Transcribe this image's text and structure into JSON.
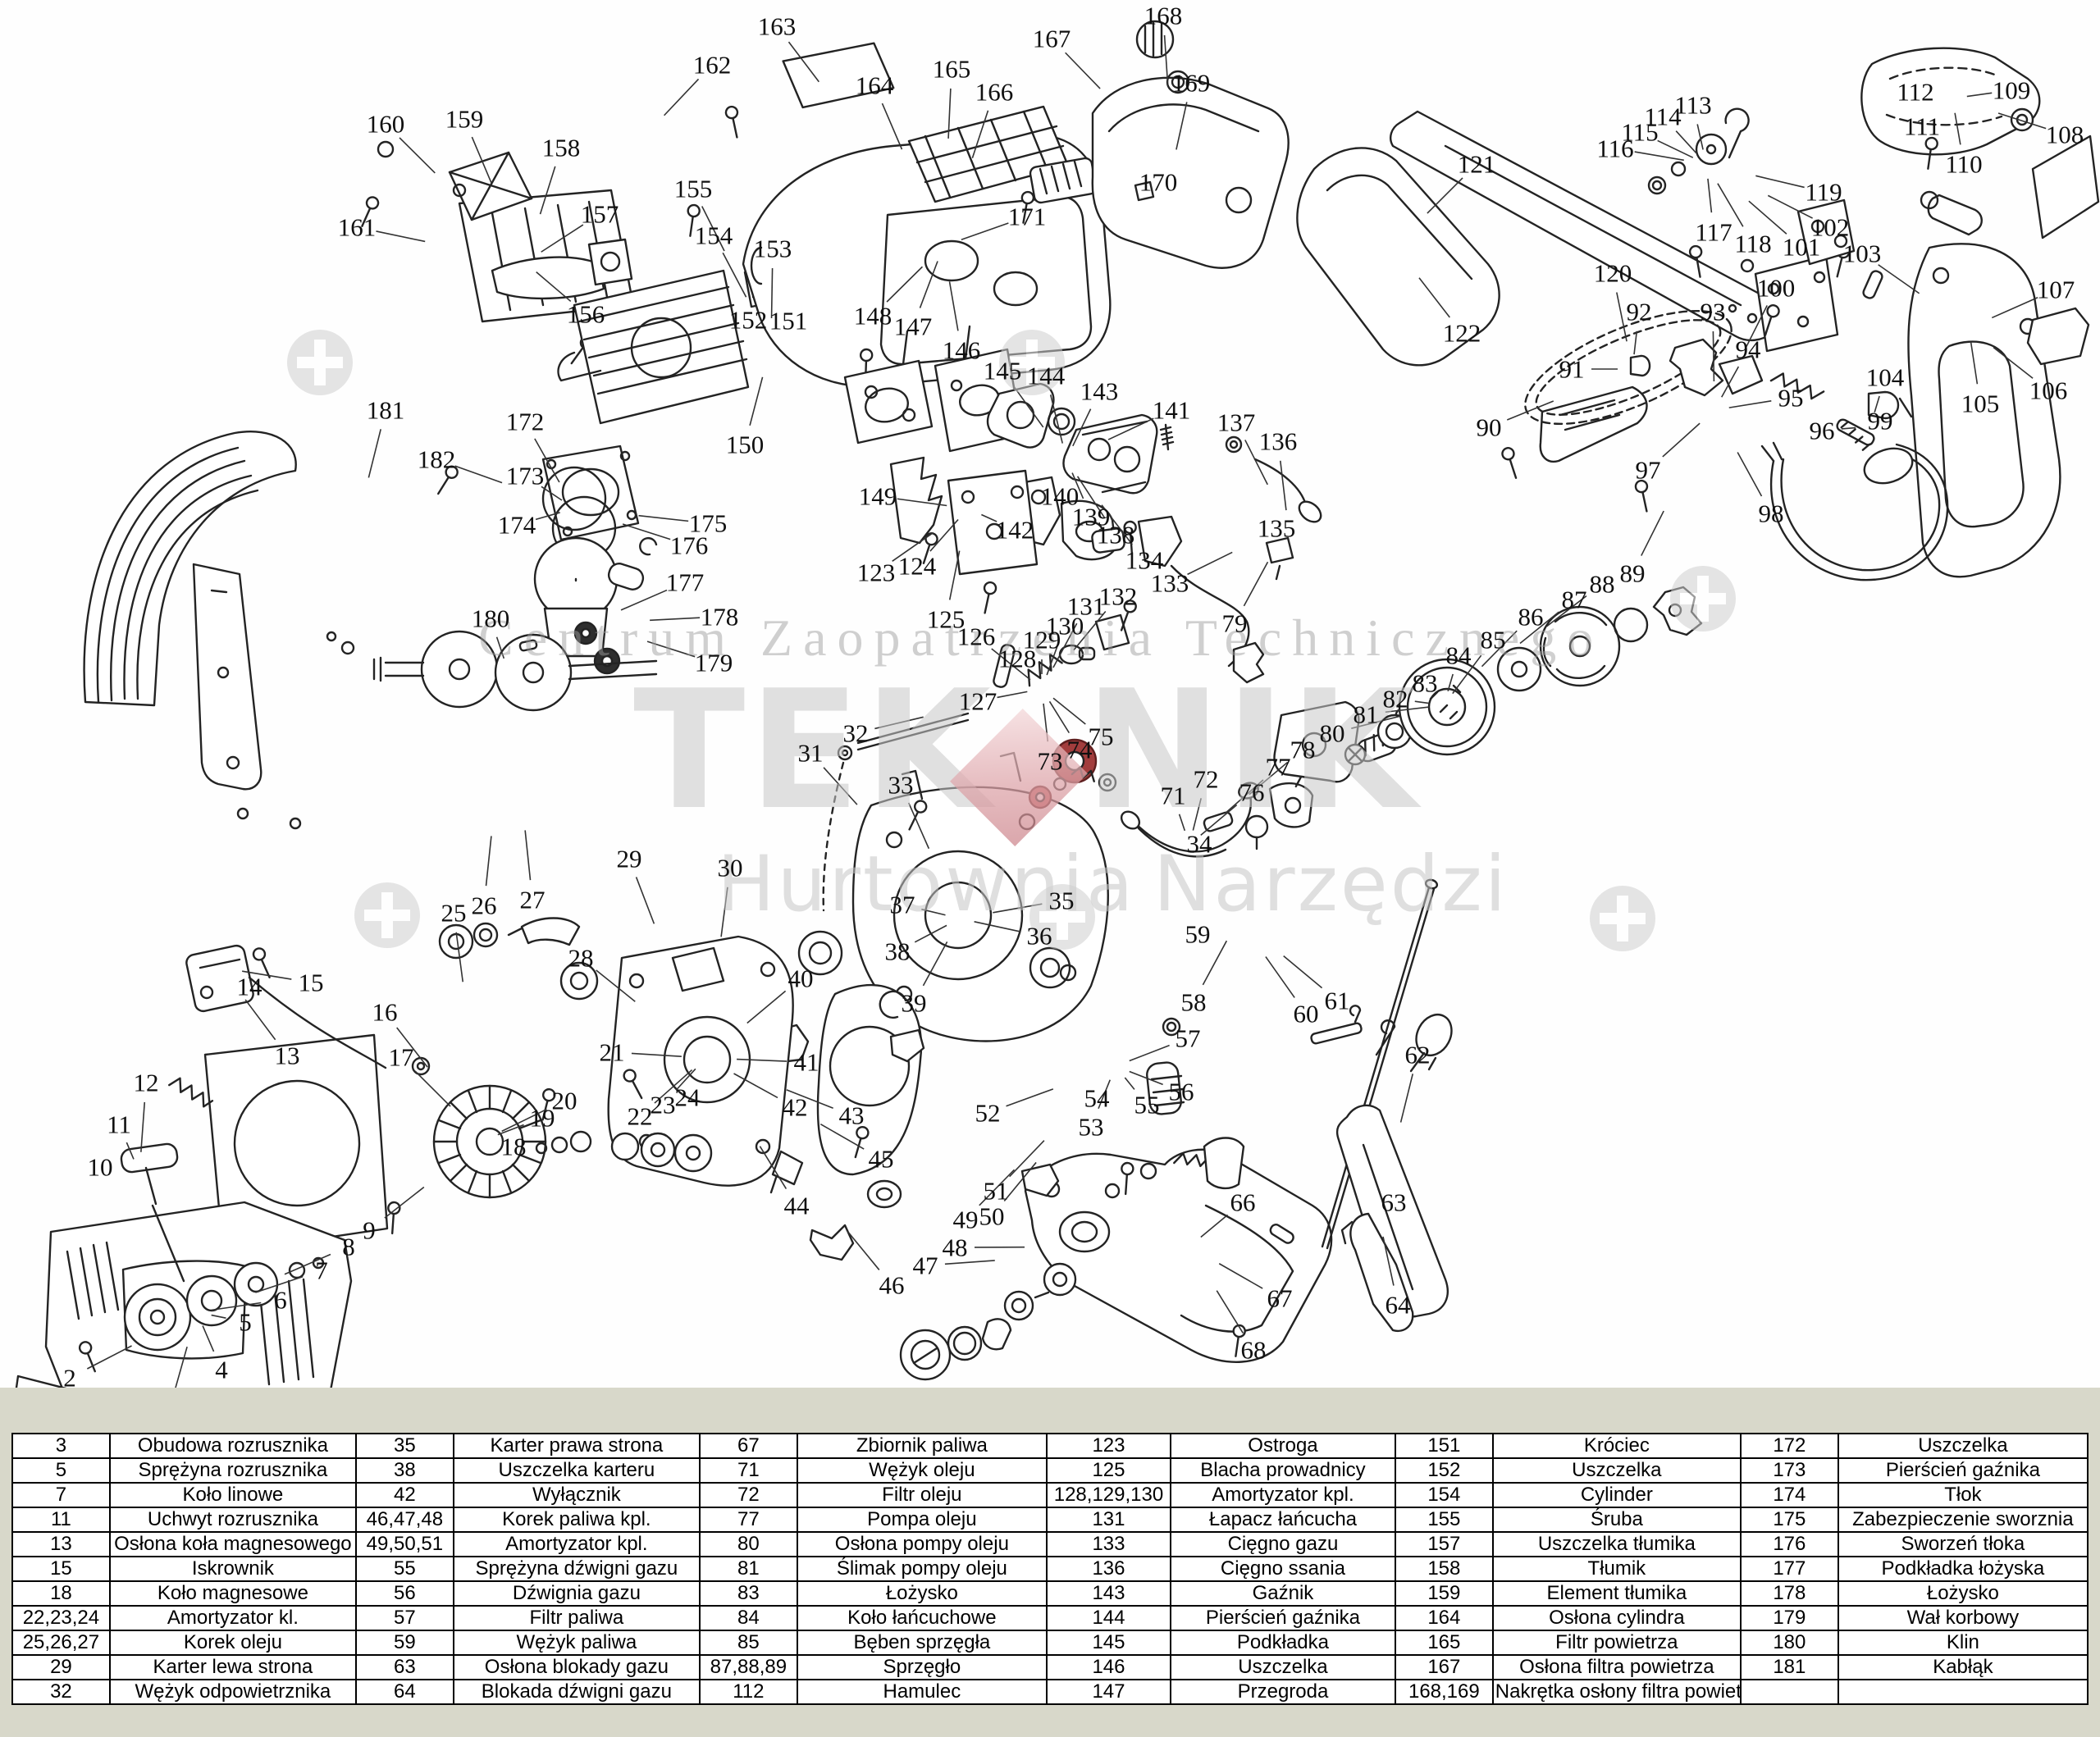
{
  "page": {
    "background_color": "#d8d8ca",
    "diagram_background_color": "#fefefe",
    "accent_red": "#a23d3d"
  },
  "watermark": {
    "top_line": "Centrum Zaopatrzenia Technicznego",
    "brand_left": "TEK",
    "brand_right": "NIK",
    "bottom_left_word": "Hurtownia",
    "bottom_right_word": "Narzędzi",
    "diamond_color": "#d99ba0",
    "text_color": "#c9c9c9",
    "registration_marks": [
      [
        390,
        442
      ],
      [
        1258,
        442
      ],
      [
        2076,
        730
      ],
      [
        472,
        1116
      ],
      [
        1295,
        1118
      ],
      [
        1978,
        1120
      ]
    ]
  },
  "diagram": {
    "type": "exploded-parts-diagram",
    "subject": "chainsaw",
    "part_labels": [
      [
        "1",
        75,
        1758
      ],
      [
        "2",
        85,
        1680
      ],
      [
        "3",
        205,
        1724
      ],
      [
        "4",
        270,
        1670
      ],
      [
        "5",
        299,
        1612
      ],
      [
        "6",
        342,
        1585
      ],
      [
        "7",
        392,
        1549
      ],
      [
        "8",
        425,
        1520
      ],
      [
        "9",
        450,
        1500
      ],
      [
        "10",
        122,
        1423
      ],
      [
        "11",
        145,
        1371
      ],
      [
        "12",
        178,
        1320
      ],
      [
        "13",
        350,
        1287
      ],
      [
        "14",
        304,
        1203
      ],
      [
        "15",
        379,
        1198
      ],
      [
        "16",
        469,
        1234
      ],
      [
        "17",
        489,
        1289
      ],
      [
        "18",
        626,
        1398
      ],
      [
        "19",
        661,
        1363
      ],
      [
        "20",
        688,
        1342
      ],
      [
        "21",
        746,
        1283
      ],
      [
        "22",
        780,
        1361
      ],
      [
        "23",
        808,
        1347
      ],
      [
        "24",
        838,
        1338
      ],
      [
        "25",
        553,
        1113
      ],
      [
        "26",
        590,
        1104
      ],
      [
        "27",
        649,
        1097
      ],
      [
        "28",
        708,
        1168
      ],
      [
        "29",
        767,
        1047
      ],
      [
        "30",
        890,
        1058
      ],
      [
        "31",
        988,
        918
      ],
      [
        "32",
        1043,
        894
      ],
      [
        "33",
        1098,
        957
      ],
      [
        "34",
        1462,
        1029
      ],
      [
        "35",
        1294,
        1098
      ],
      [
        "36",
        1267,
        1141
      ],
      [
        "37",
        1100,
        1103
      ],
      [
        "38",
        1094,
        1160
      ],
      [
        "39",
        1114,
        1223
      ],
      [
        "40",
        976,
        1193
      ],
      [
        "41",
        983,
        1295
      ],
      [
        "42",
        969,
        1350
      ],
      [
        "43",
        1038,
        1360
      ],
      [
        "44",
        971,
        1470
      ],
      [
        "45",
        1074,
        1413
      ],
      [
        "46",
        1087,
        1567
      ],
      [
        "47",
        1128,
        1543
      ],
      [
        "48",
        1164,
        1521
      ],
      [
        "49",
        1177,
        1487
      ],
      [
        "50",
        1209,
        1483
      ],
      [
        "51",
        1214,
        1452
      ],
      [
        "52",
        1204,
        1357
      ],
      [
        "53",
        1330,
        1374
      ],
      [
        "54",
        1337,
        1339
      ],
      [
        "55",
        1398,
        1347
      ],
      [
        "56",
        1440,
        1331
      ],
      [
        "57",
        1448,
        1266
      ],
      [
        "58",
        1455,
        1222
      ],
      [
        "59",
        1460,
        1139
      ],
      [
        "60",
        1592,
        1236
      ],
      [
        "61",
        1630,
        1220
      ],
      [
        "62",
        1728,
        1286
      ],
      [
        "63",
        1699,
        1466
      ],
      [
        "64",
        1704,
        1591
      ],
      [
        "66",
        1515,
        1466
      ],
      [
        "67",
        1560,
        1583
      ],
      [
        "68",
        1528,
        1646
      ],
      [
        "71",
        1430,
        970
      ],
      [
        "72",
        1470,
        950
      ],
      [
        "73",
        1280,
        928
      ],
      [
        "74",
        1316,
        914
      ],
      [
        "75",
        1342,
        898
      ],
      [
        "76",
        1526,
        966
      ],
      [
        "77",
        1558,
        935
      ],
      [
        "78",
        1588,
        914
      ],
      [
        "79",
        1505,
        760
      ],
      [
        "80",
        1624,
        894
      ],
      [
        "81",
        1665,
        871
      ],
      [
        "82",
        1701,
        852
      ],
      [
        "83",
        1737,
        833
      ],
      [
        "84",
        1778,
        799
      ],
      [
        "85",
        1820,
        780
      ],
      [
        "86",
        1866,
        752
      ],
      [
        "87",
        1919,
        731
      ],
      [
        "88",
        1953,
        712
      ],
      [
        "89",
        1990,
        699
      ],
      [
        "90",
        1815,
        521
      ],
      [
        "91",
        1916,
        450
      ],
      [
        "92",
        1998,
        380
      ],
      [
        "93",
        2088,
        380
      ],
      [
        "94",
        2131,
        426
      ],
      [
        "95",
        2183,
        485
      ],
      [
        "96",
        2221,
        525
      ],
      [
        "97",
        2009,
        573
      ],
      [
        "98",
        2159,
        626
      ],
      [
        "99",
        2292,
        513
      ],
      [
        "100",
        2165,
        351
      ],
      [
        "101",
        2196,
        301
      ],
      [
        "102",
        2231,
        277
      ],
      [
        "103",
        2270,
        309
      ],
      [
        "104",
        2298,
        460
      ],
      [
        "105",
        2414,
        492
      ],
      [
        "106",
        2497,
        476
      ],
      [
        "107",
        2506,
        353
      ],
      [
        "108",
        2517,
        164
      ],
      [
        "109",
        2452,
        110
      ],
      [
        "110",
        2394,
        200
      ],
      [
        "111",
        2343,
        154
      ],
      [
        "112",
        2335,
        112
      ],
      [
        "113",
        2064,
        128
      ],
      [
        "114",
        2027,
        142
      ],
      [
        "115",
        1999,
        161
      ],
      [
        "116",
        1969,
        181
      ],
      [
        "117",
        2089,
        283
      ],
      [
        "118",
        2137,
        297
      ],
      [
        "119",
        2223,
        234
      ],
      [
        "120",
        1966,
        333
      ],
      [
        "121",
        1800,
        200
      ],
      [
        "122",
        1782,
        406
      ],
      [
        "123",
        1068,
        698
      ],
      [
        "124",
        1118,
        690
      ],
      [
        "125",
        1153,
        755
      ],
      [
        "126",
        1190,
        776
      ],
      [
        "127",
        1192,
        855
      ],
      [
        "128",
        1240,
        803
      ],
      [
        "129",
        1270,
        780
      ],
      [
        "130",
        1298,
        763
      ],
      [
        "131",
        1324,
        739
      ],
      [
        "132",
        1363,
        727
      ],
      [
        "133",
        1426,
        711
      ],
      [
        "134",
        1395,
        683
      ],
      [
        "135",
        1556,
        644
      ],
      [
        "136",
        1558,
        538
      ],
      [
        "137",
        1507,
        515
      ],
      [
        "138",
        1360,
        652
      ],
      [
        "139",
        1330,
        630
      ],
      [
        "140",
        1292,
        605
      ],
      [
        "141",
        1428,
        500
      ],
      [
        "142",
        1237,
        646
      ],
      [
        "143",
        1340,
        477
      ],
      [
        "144",
        1275,
        458
      ],
      [
        "145",
        1222,
        452
      ],
      [
        "146",
        1172,
        427
      ],
      [
        "147",
        1113,
        398
      ],
      [
        "148",
        1064,
        385
      ],
      [
        "149",
        1070,
        605
      ],
      [
        "150",
        908,
        542
      ],
      [
        "151",
        961,
        391
      ],
      [
        "152",
        912,
        390
      ],
      [
        "153",
        942,
        303
      ],
      [
        "154",
        870,
        287
      ],
      [
        "155",
        845,
        230
      ],
      [
        "156",
        714,
        383
      ],
      [
        "157",
        731,
        261
      ],
      [
        "158",
        684,
        180
      ],
      [
        "159",
        566,
        145
      ],
      [
        "160",
        470,
        151
      ],
      [
        "161",
        435,
        277
      ],
      [
        "162",
        868,
        79
      ],
      [
        "163",
        947,
        32
      ],
      [
        "164",
        1066,
        104
      ],
      [
        "165",
        1160,
        84
      ],
      [
        "166",
        1212,
        112
      ],
      [
        "167",
        1282,
        47
      ],
      [
        "168",
        1418,
        19
      ],
      [
        "169",
        1452,
        101
      ],
      [
        "170",
        1412,
        222
      ],
      [
        "171",
        1252,
        264
      ],
      [
        "172",
        640,
        514
      ],
      [
        "173",
        640,
        580
      ],
      [
        "174",
        630,
        640
      ],
      [
        "175",
        863,
        638
      ],
      [
        "176",
        840,
        665
      ],
      [
        "177",
        835,
        710
      ],
      [
        "178",
        877,
        752
      ],
      [
        "179",
        870,
        808
      ],
      [
        "180",
        598,
        754
      ],
      [
        "181",
        470,
        500
      ],
      [
        "182",
        532,
        560
      ]
    ]
  },
  "parts_table": {
    "rows": [
      [
        "3",
        "Obudowa rozrusznika",
        "35",
        "Karter prawa strona",
        "67",
        "Zbiornik paliwa",
        "123",
        "Ostroga",
        "151",
        "Króciec",
        "172",
        "Uszczelka"
      ],
      [
        "5",
        "Sprężyna rozrusznika",
        "38",
        "Uszczelka karteru",
        "71",
        "Wężyk oleju",
        "125",
        "Blacha prowadnicy",
        "152",
        "Uszczelka",
        "173",
        "Pierścień gaźnika"
      ],
      [
        "7",
        "Koło linowe",
        "42",
        "Wyłącznik",
        "72",
        "Filtr oleju",
        "128,129,130",
        "Amortyzator kpl.",
        "154",
        "Cylinder",
        "174",
        "Tłok"
      ],
      [
        "11",
        "Uchwyt rozrusznika",
        "46,47,48",
        "Korek paliwa kpl.",
        "77",
        "Pompa oleju",
        "131",
        "Łapacz łańcucha",
        "155",
        "Śruba",
        "175",
        "Zabezpieczenie sworznia"
      ],
      [
        "13",
        "Osłona koła magnesowego",
        "49,50,51",
        "Amortyzator kpl.",
        "80",
        "Osłona pompy oleju",
        "133",
        "Cięgno gazu",
        "157",
        "Uszczelka tłumika",
        "176",
        "Sworzeń tłoka"
      ],
      [
        "15",
        "Iskrownik",
        "55",
        "Sprężyna dźwigni gazu",
        "81",
        "Ślimak pompy oleju",
        "136",
        "Cięgno ssania",
        "158",
        "Tłumik",
        "177",
        "Podkładka łożyska"
      ],
      [
        "18",
        "Koło magnesowe",
        "56",
        "Dźwignia gazu",
        "83",
        "Łożysko",
        "143",
        "Gaźnik",
        "159",
        "Element tłumika",
        "178",
        "Łożysko"
      ],
      [
        "22,23,24",
        "Amortyzator kl.",
        "57",
        "Filtr paliwa",
        "84",
        "Koło łańcuchowe",
        "144",
        "Pierścień gaźnika",
        "164",
        "Osłona cylindra",
        "179",
        "Wał korbowy"
      ],
      [
        "25,26,27",
        "Korek oleju",
        "59",
        "Wężyk paliwa",
        "85",
        "Bęben sprzęgła",
        "145",
        "Podkładka",
        "165",
        "Filtr powietrza",
        "180",
        "Klin"
      ],
      [
        "29",
        "Karter lewa strona",
        "63",
        "Osłona blokady gazu",
        "87,88,89",
        "Sprzęgło",
        "146",
        "Uszczelka",
        "167",
        "Osłona filtra powietrza",
        "181",
        "Kabłąk"
      ],
      [
        "32",
        "Wężyk odpowietrznika",
        "64",
        "Blokada dźwigni gazu",
        "112",
        "Hamulec",
        "147",
        "Przegroda",
        "168,169",
        "Nakrętka osłony filtra powietrza",
        "",
        ""
      ]
    ]
  }
}
